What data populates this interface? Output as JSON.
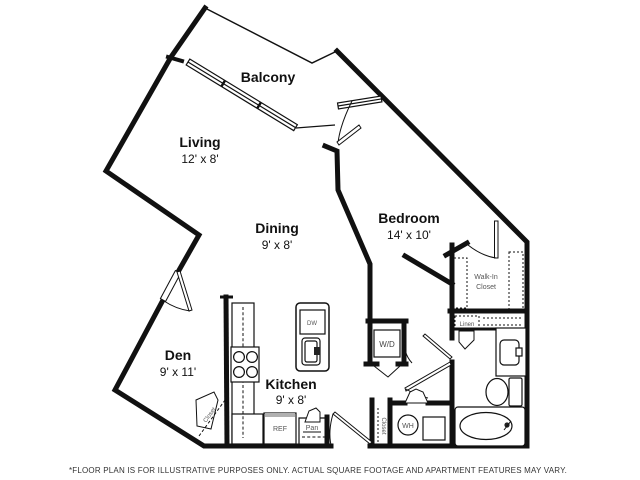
{
  "floor_plan": {
    "rooms": [
      {
        "name": "Balcony",
        "dims": ""
      },
      {
        "name": "Living",
        "dims": "12' x 8'"
      },
      {
        "name": "Dining",
        "dims": "9' x 8'"
      },
      {
        "name": "Bedroom",
        "dims": "14' x 10'"
      },
      {
        "name": "Den",
        "dims": "9' x 11'"
      },
      {
        "name": "Kitchen",
        "dims": "9' x 8'"
      }
    ],
    "features": {
      "walk_in_line1": "Walk-In",
      "walk_in_line2": "Closet",
      "linen": "Linen",
      "washer_dryer": "W/D",
      "dishwasher": "DW",
      "refrigerator": "REF",
      "pantry": "Pan",
      "den_closet": "Closet",
      "hall_closet": "Closet",
      "water_heater": "WH"
    },
    "disclaimer": "*FLOOR PLAN IS FOR ILLUSTRATIVE PURPOSES ONLY. ACTUAL SQUARE FOOTAGE AND APARTMENT FEATURES MAY VARY.",
    "colors": {
      "wall": "#111111",
      "background": "#ffffff",
      "text": "#111111",
      "small_label": "#555555",
      "disclaimer": "#333333"
    }
  }
}
